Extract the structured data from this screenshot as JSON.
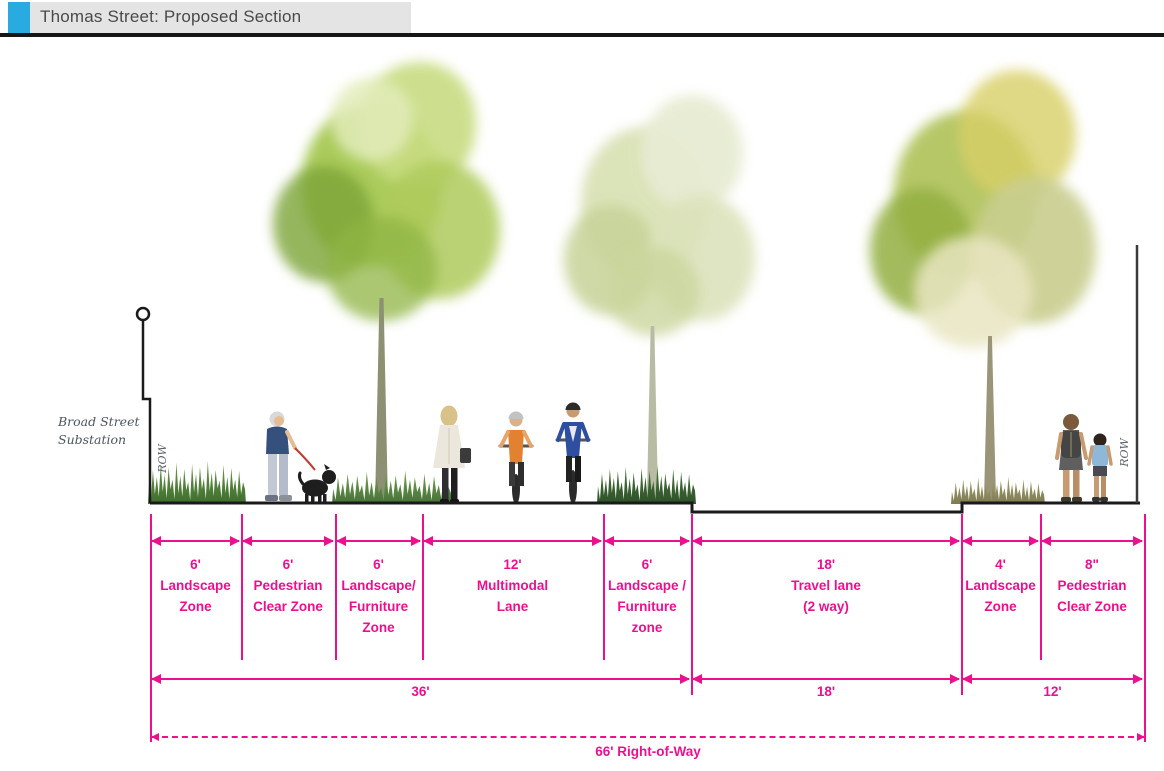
{
  "header": {
    "title": "Thomas Street: Proposed Section",
    "accent_color": "#29ABE2",
    "bar_color": "#E4E4E4"
  },
  "colors": {
    "dimension": "#EC108F",
    "outline": "#1A1A1A"
  },
  "annotations": {
    "side_note_line1": "Broad Street",
    "side_note_line2": "Substation",
    "row_left": "ROW",
    "row_right": "ROW"
  },
  "section": {
    "zones": [
      {
        "size": "6'",
        "l1": "Landscape",
        "l2": "Zone"
      },
      {
        "size": "6'",
        "l1": "Pedestrian",
        "l2": "Clear Zone"
      },
      {
        "size": "6'",
        "l1": "Landscape/",
        "l2": "Furniture",
        "l3": "Zone"
      },
      {
        "size": "12'",
        "l1": "Multimodal",
        "l2": "Lane"
      },
      {
        "size": "6'",
        "l1": "Landscape /",
        "l2": "Furniture",
        "l3": "zone"
      },
      {
        "size": "18'",
        "l1": "Travel lane",
        "l2": "(2 way)"
      },
      {
        "size": "4'",
        "l1": "Landscape",
        "l2": "Zone"
      },
      {
        "size": "8\"",
        "l1": "Pedestrian",
        "l2": "Clear Zone"
      }
    ],
    "groups": [
      {
        "label": "36'"
      },
      {
        "label": "18'"
      },
      {
        "label": "12'"
      }
    ],
    "total_label": "66' Right-of-Way"
  }
}
